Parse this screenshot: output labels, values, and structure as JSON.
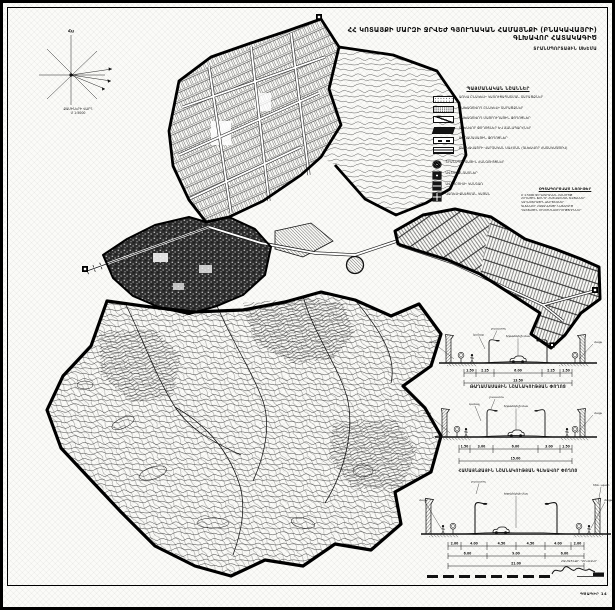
{
  "title": {
    "main": "ՀՀ ԿՈՏԱՅՔԻ ՄԱՐԶԻ ՋՐՎԵԺ ԳՅՈՒՂԱԿԱՆ ՀԱՄԱՅՆՔԻ (ԲՆԱԿԱՎԱՅՐԻ) ԳԼԽԱՎՈՐ ՀԱՏԱԿԱԳԻԾ",
    "sub": "ՏՐԱՆՍՊՈՐՏԱՅԻՆ ՍԽԵՄԱ"
  },
  "compass": {
    "north": "Հս",
    "caption": "ՔԱՄԻՆԵՐԻ ՎԱՐԴ",
    "scale": "Մ 1:5000"
  },
  "legend": {
    "header": "ՊԱՅՄԱՆԱԿԱՆ ՆՇԱՆՆԵՐ",
    "items": [
      {
        "symbol": "dots-light-swatch",
        "label": "ԱՌԿԱ ԲՆԱԿԵԼԻ ԿԱՌՈՒՑԱՊԱՏՄԱՆ ՏԱՐԱԾՔՆԵՐ"
      },
      {
        "symbol": "dots-dense-swatch",
        "label": "ՆԱԽԱԳԾՎՈՂ ԲՆԱԿԵԼԻ ՏԱՐԱԾՔՆԵՐ"
      },
      {
        "symbol": "diagonal-line-swatch",
        "label": "ՆԱԽԱԳԾՎՈՂ ՄԱՅՐՈՒՂԱՅԻՆ ՓՈՂՈՑՆԵՐ"
      },
      {
        "symbol": "black-bar-swatch",
        "label": "ԳԼԽԱՎՈՐ ՓՈՂՈՑՆԵՐ ԵՎ ՃԱՆԱՊԱՐՀՆԵՐ"
      },
      {
        "symbol": "dash-swatch",
        "label": "ԹԱՂԱՄԱՍԱՅԻՆ ՓՈՂՈՑՆԵՐ"
      },
      {
        "symbol": "rows-swatch",
        "label": "ԲՆԱԿԱՎԱՅՐԻ ՎԱՐՉԱԿԱՆ ՍԱՀՄԱՆ (ԳԼԽԱՎՈՐ ՀԱՏԱԿԱԳԾՈՎ)"
      },
      {
        "symbol": "junction-icon",
        "label": "ՏՐԱՆՍՊՈՐՏԱՅԻՆ ՀԱՆԳՈՒՅՑՆԵՐ"
      },
      {
        "symbol": "parking-icon",
        "label": "ԱՎՏՈԿԱՆԳԱՌՆԵՐ"
      },
      {
        "symbol": "bus-stop-icon",
        "label": "ԱՎՏՈԲՈՒՍԻ ԿԱՆԳԱՌ"
      },
      {
        "symbol": "fuel-station-icon",
        "label": "ՎԱՌԵԼԻՔԱԼՑՄԱՆ ԿԱՅԱՆ"
      }
    ]
  },
  "materials": {
    "header": "ՕԳՏԱԳՈՐԾՎԱԾ ՆՅՈՒԹԵՐ",
    "lines": [
      "Մ 1:5000 ՏԵՂԱԳՐԱԿԱՆ ՀԱՆՈՒՅԹ",
      "ՀՈՂԱՅԻՆ ՖՈՆԴԻ ՀԱՇՎԱՌՄԱՆ ՏՎՅԱԼՆԵՐ",
      "ԿԱԴԱՍՏՐԱՅԻՆ ՔԱՐՏԵԶՆԵՐ",
      "ԳԼԽԱՎՈՐ ՀԱՏԱԿԱԳԾԻ ՆԱԽԱԳԻԾ",
      "ԴԱՇՏԱՅԻՆ ՈՒՍՈՒՄՆԱՍԻՐՈՒԹՅՈՒՆՆԵՐ"
    ]
  },
  "section_labels": {
    "sidewalk": "մայթ",
    "green": "կանաչ",
    "road": "երթևեկելի մաս",
    "lamp": "լուսատու",
    "wall": "հեն. պատ"
  },
  "sections": [
    {
      "dims": [
        "1.50",
        "2.25",
        "6.00",
        "2.25",
        "1.50"
      ],
      "total": "13.50"
    },
    {
      "caption": "ԹԱՂԱՄԱՍԱՅԻՆ ՆՇԱՆԱԿՈՒԹՅԱՆ ՓՈՂՈՑ",
      "dims": [
        "1.50",
        "3.00",
        "6.00",
        "3.00",
        "1.50"
      ],
      "total": "15.00"
    },
    {
      "caption": "ՀԱՄԱՅՆՔԱՅԻՆ ՆՇԱՆԱԿՈՒԹՅԱՆ ԳԼԽԱՎՈՐ ՓՈՂՈՑ",
      "dims": [
        "2.00",
        "4.00",
        "4.50",
        "4.50",
        "4.00",
        "2.00"
      ],
      "dims2": [
        "6.00",
        "9.00",
        "6.00"
      ],
      "total": "21.00"
    }
  ],
  "signature": {
    "label": "ՀԱՄԱՅՆՔԻ ՂԵԿԱՎԱՐ"
  },
  "sheet_label": "ԳԾԱԳԻՐ 14",
  "colors": {
    "ink": "#111111",
    "paper": "#fbfbf8"
  }
}
